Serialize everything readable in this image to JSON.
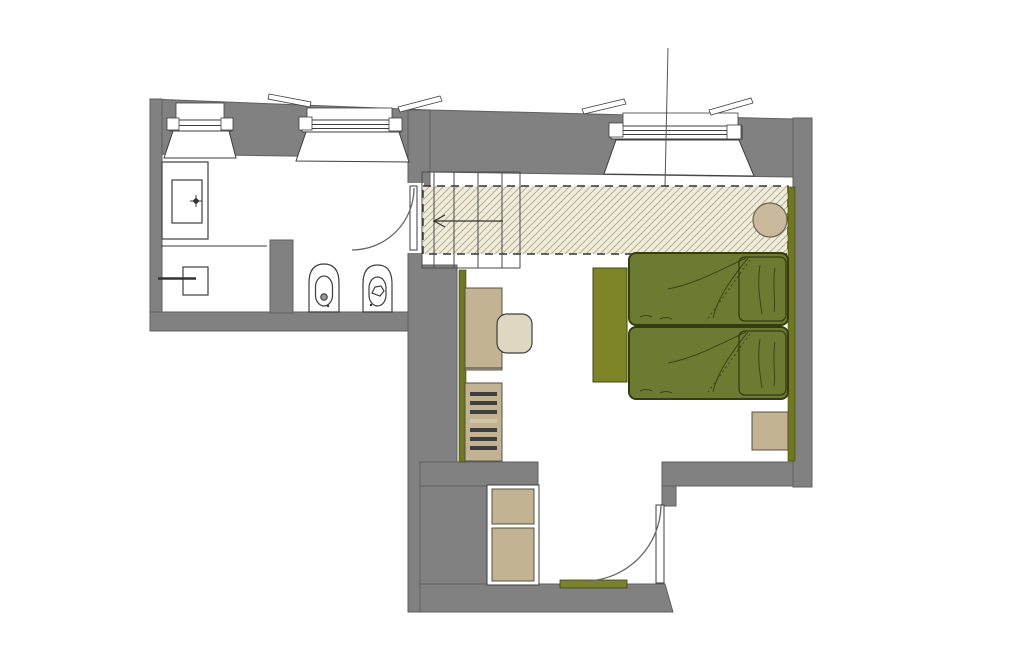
{
  "palette": {
    "background": "#ffffff",
    "wall-gray": "#818181",
    "wall-shadow": "#5f5f5f",
    "line-dark": "#3e3e3e",
    "door-arc": "#666666",
    "hatch-bg": "#efecdb",
    "hatch-line": "#b7b094",
    "bed-green": "#6d7a32",
    "bed-outline": "#333d10",
    "bench-olive": "#7d8526",
    "strip-olive": "#6f7820",
    "mat-olive": "#7a8130",
    "furniture-tan": "#c2b392",
    "furniture-outline": "#575144",
    "chair-cream": "#ded8c0",
    "table-tan": "#c9b99d"
  }
}
